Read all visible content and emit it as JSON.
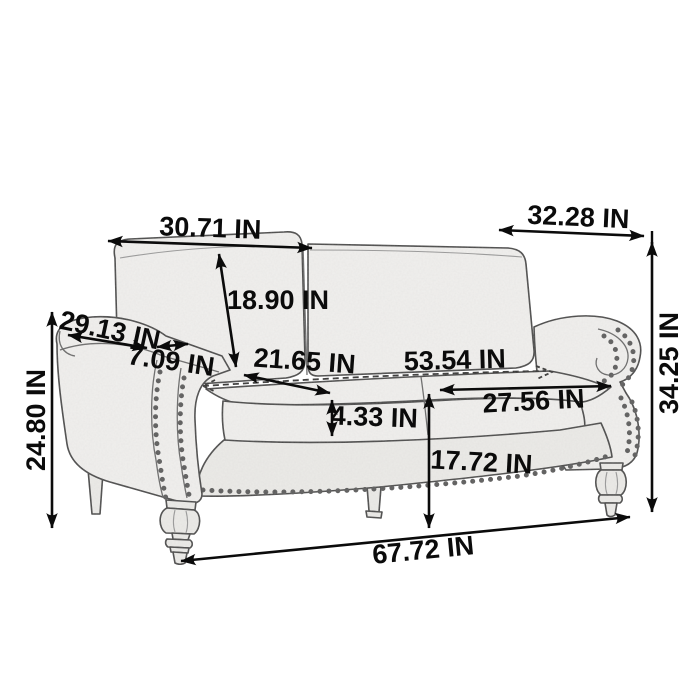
{
  "diagram": {
    "type": "product-dimension-diagram",
    "subject": "loveseat sofa line-art sketch with nailhead trim and turned front legs",
    "unit": "IN",
    "dimensions": {
      "back_width": "30.71 IN",
      "depth": "32.28 IN",
      "back_cushion_height": "18.90 IN",
      "arm_front_length": "29.13 IN",
      "arm_top_width": "7.09 IN",
      "arm_height": "24.80 IN",
      "seat_cushion_depth": "21.65 IN",
      "seat_width": "53.54 IN",
      "seat_cushion_thickness": "4.33 IN",
      "seat_depth": "27.56 IN",
      "seat_height": "17.72 IN",
      "overall_height": "34.25 IN",
      "overall_length": "67.72 IN"
    },
    "colors": {
      "background": "#ffffff",
      "dimension_line": "#0b0b0b",
      "sketch_outline": "#474747",
      "sketch_fill": "#f1f0ee"
    }
  }
}
